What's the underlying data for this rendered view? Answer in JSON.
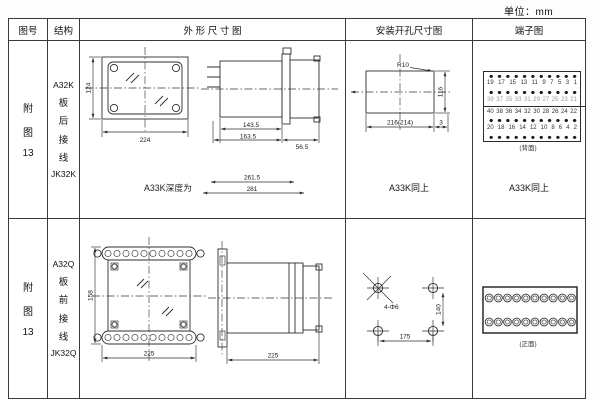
{
  "unit_note": "单位：mm",
  "header": {
    "fig": "图号",
    "struct": "结构",
    "outline": "外 形 尺 寸 图",
    "install": "安装开孔尺寸图",
    "terminal": "端子图"
  },
  "row1": {
    "fig": {
      "l1": "附",
      "l2": "图",
      "l3": "13"
    },
    "struct": {
      "l1": "A32K",
      "l2": "板",
      "l3": "后",
      "l4": "接",
      "l5": "线",
      "l6": "JK32K"
    },
    "outline": {
      "front_h": "124",
      "front_w": "224",
      "depth_inner": "143.5",
      "depth_outer": "163.5",
      "flange_d": "56.5",
      "note": "A33K深度为",
      "note_d1": "261.5",
      "note_d2": "281"
    },
    "install": {
      "r": "R10",
      "h": "116",
      "w": "216(214)",
      "edge": "3",
      "same": "A33K同上"
    },
    "terminal": {
      "nums1": [
        "19",
        "17",
        "15",
        "13",
        "11",
        "9",
        "7",
        "5",
        "3",
        "1"
      ],
      "nums2": [
        "39",
        "37",
        "35",
        "33",
        "31",
        "29",
        "27",
        "25",
        "23",
        "21"
      ],
      "nums3": [
        "40",
        "38",
        "36",
        "34",
        "32",
        "30",
        "28",
        "26",
        "24",
        "22"
      ],
      "nums4": [
        "20",
        "18",
        "16",
        "14",
        "12",
        "10",
        "8",
        "6",
        "4",
        "2"
      ],
      "caption": "(背面)",
      "same": "A33K同上"
    }
  },
  "row2": {
    "fig": {
      "l1": "附",
      "l2": "图",
      "l3": "13"
    },
    "struct": {
      "l1": "A32Q",
      "l2": "板",
      "l3": "前",
      "l4": "接",
      "l5": "线",
      "l6": "JK32Q"
    },
    "outline": {
      "front_h": "158",
      "front_w": "225",
      "side_d": "225"
    },
    "install": {
      "holes": "4-Φ6",
      "h": "140",
      "w": "175"
    },
    "terminal": {
      "caption": "(正面)"
    }
  }
}
